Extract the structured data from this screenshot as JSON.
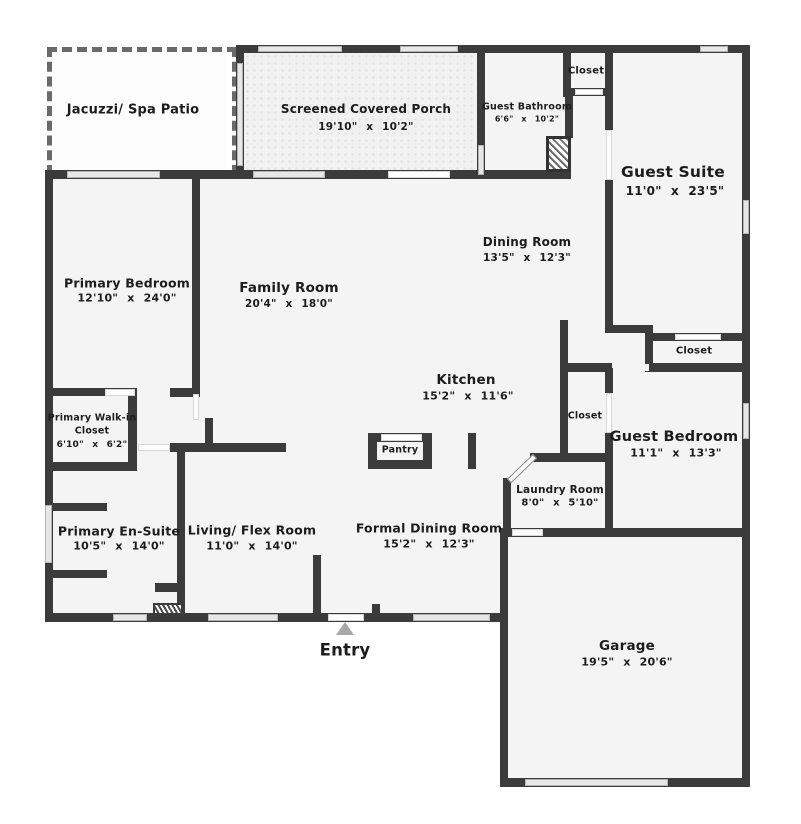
{
  "colors": {
    "wall": "#3b3b3b",
    "floor": "#f4f4f4",
    "window": "#e7e7e7",
    "entry_marker": "#a8a8a8"
  },
  "rooms": {
    "jacuzzi": {
      "name": "Jacuzzi/ Spa Patio"
    },
    "porch": {
      "name": "Screened Covered Porch",
      "dims": "19'10\" x 10'2\""
    },
    "guest_bathroom": {
      "name": "Guest Bathroom",
      "dims": "6'6\" x 10'2\""
    },
    "closet_top": {
      "name": "Closet"
    },
    "guest_suite": {
      "name": "Guest Suite",
      "dims": "11'0\" x 23'5\""
    },
    "dining": {
      "name": "Dining Room",
      "dims": "13'5\" x 12'3\""
    },
    "family": {
      "name": "Family Room",
      "dims": "20'4\" x 18'0\""
    },
    "primary_bedroom": {
      "name": "Primary Bedroom",
      "dims": "12'10\" x 24'0\""
    },
    "closet_right": {
      "name": "Closet"
    },
    "kitchen": {
      "name": "Kitchen",
      "dims": "15'2\" x 11'6\""
    },
    "walkin": {
      "line1": "Primary Walk-in",
      "line2": "Closet",
      "dims": "6'10\" x 6'2\""
    },
    "closet_mid": {
      "name": "Closet"
    },
    "guest_bedroom": {
      "name": "Guest Bedroom",
      "dims": "11'1\" x 13'3\""
    },
    "pantry": {
      "name": "Pantry"
    },
    "laundry": {
      "name": "Laundry Room",
      "dims": "8'0\" x 5'10\""
    },
    "ensuite": {
      "name": "Primary En-Suite",
      "dims": "10'5\" x 14'0\""
    },
    "living": {
      "name": "Living/ Flex Room",
      "dims": "11'0\" x 14'0\""
    },
    "formal_dining": {
      "name": "Formal Dining Room",
      "dims": "15'2\" x 12'3\""
    },
    "garage": {
      "name": "Garage",
      "dims": "19'5\" x 20'6\""
    },
    "entry": {
      "name": "Entry"
    }
  }
}
